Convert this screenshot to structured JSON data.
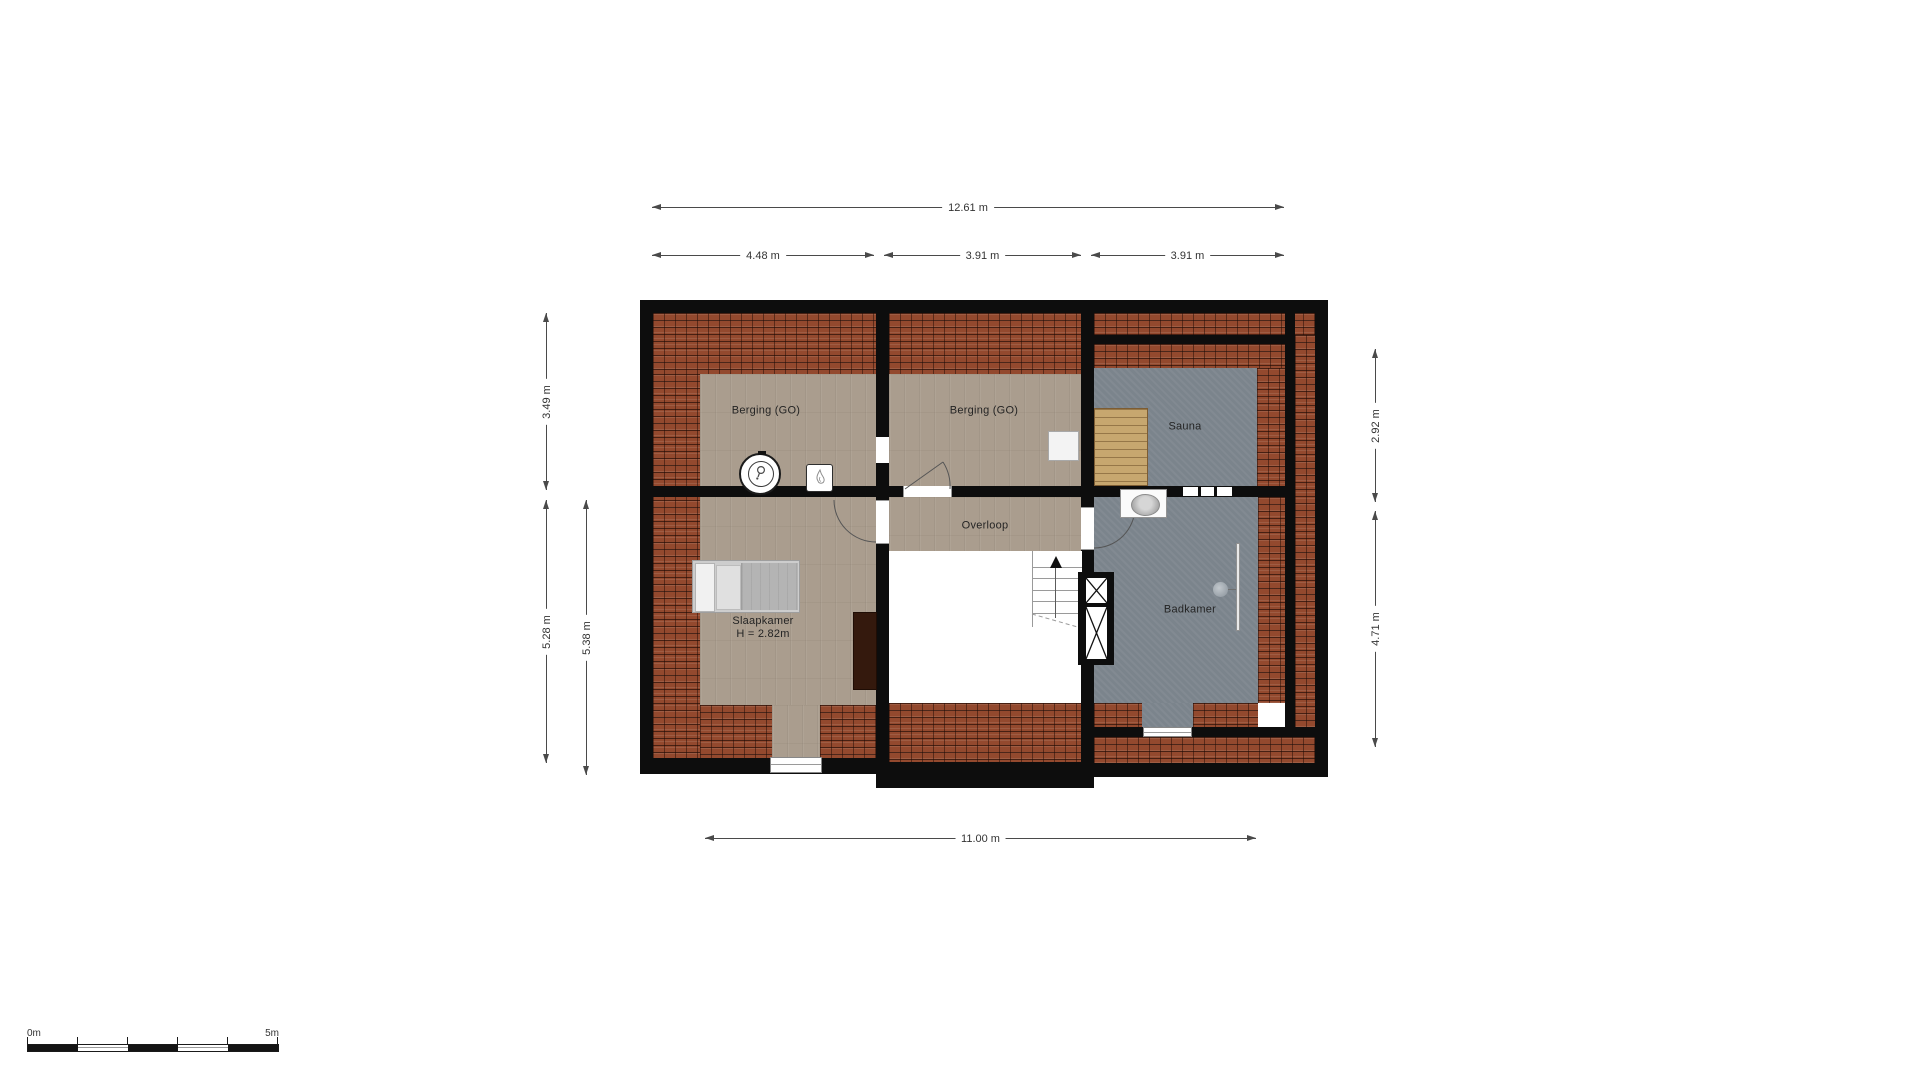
{
  "rooms": {
    "berging_left": "Berging (GO)",
    "berging_right": "Berging (GO)",
    "sauna": "Sauna",
    "overloop": "Overloop",
    "slaapkamer": "Slaapkamer",
    "slaapkamer_height": "H = 2.82m",
    "badkamer": "Badkamer"
  },
  "dimensions": {
    "top_total": "12.61 m",
    "top_left": "4.48 m",
    "top_middle": "3.91 m",
    "top_right": "3.91 m",
    "left_upper": "3.49 m",
    "left_lower": "5.28 m",
    "left_lower_inner": "5.38 m",
    "right_upper": "2.92 m",
    "right_lower": "4.71 m",
    "bottom_total": "11.00 m"
  },
  "scale_bar": {
    "start_label": "0m",
    "end_label": "5m"
  },
  "fixtures": {
    "bed": "bed",
    "wardrobe": "wardrobe",
    "ventilation_unit": "mechanical-ventilation-unit",
    "boiler": "cv-boiler",
    "cabinet": "cabinet",
    "sauna_bench": "sauna-bench",
    "sink": "washbasin",
    "shower": "shower",
    "stairs": "staircase-up",
    "shaft": "duct-shaft"
  },
  "colors": {
    "wall": "#0d0d0d",
    "roof_tiles": "#93492e",
    "roof_tile_joint": "#3f1b0e",
    "wood_floor": "#aa9d8e",
    "wet_floor": "#7b848c",
    "sauna_bench": "#c7a76f",
    "dimension": "#4a4a4a",
    "background": "#ffffff"
  }
}
